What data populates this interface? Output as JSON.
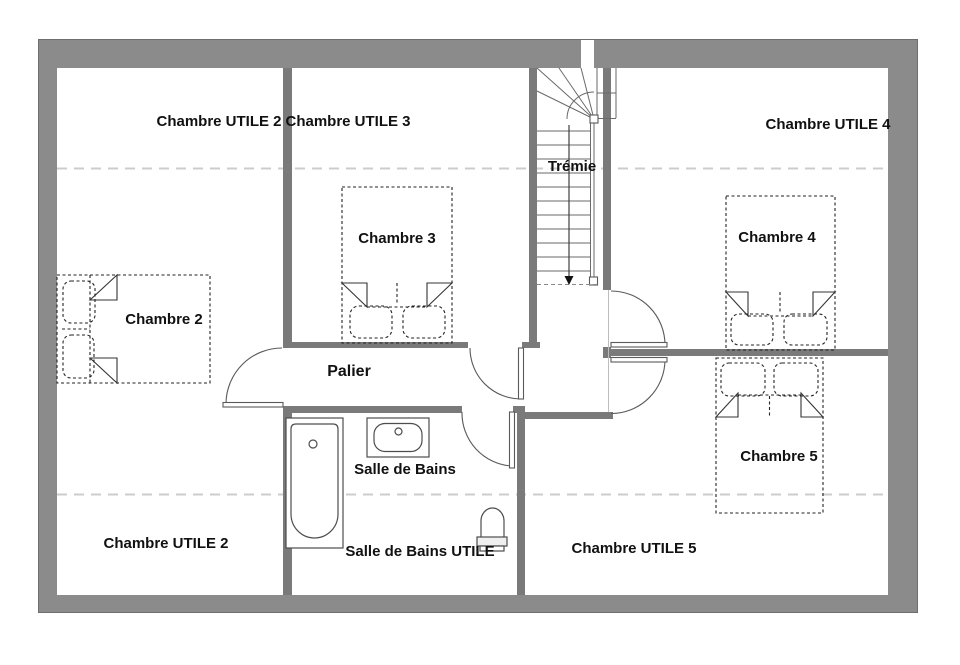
{
  "floor_plan": {
    "labels": {
      "chambre_utile_2_top": "Chambre UTILE 2",
      "chambre_utile_3": "Chambre UTILE 3",
      "chambre_utile_4": "Chambre UTILE 4",
      "tremie": "Trémie",
      "chambre_2": "Chambre 2",
      "chambre_3": "Chambre 3",
      "chambre_4": "Chambre 4",
      "chambre_5": "Chambre 5",
      "palier": "Palier",
      "salle_de_bains": "Salle de Bains",
      "salle_de_bains_utile": "Salle de Bains UTILE",
      "chambre_utile_2_bottom": "Chambre UTILE 2",
      "chambre_utile_5": "Chambre UTILE 5"
    },
    "colors": {
      "outer_wall": "#8b8b8b",
      "inner_wall": "#7a7a7a",
      "line": "#5a5a5a",
      "dashed_guide": "#cccccc",
      "text": "#111111"
    }
  }
}
